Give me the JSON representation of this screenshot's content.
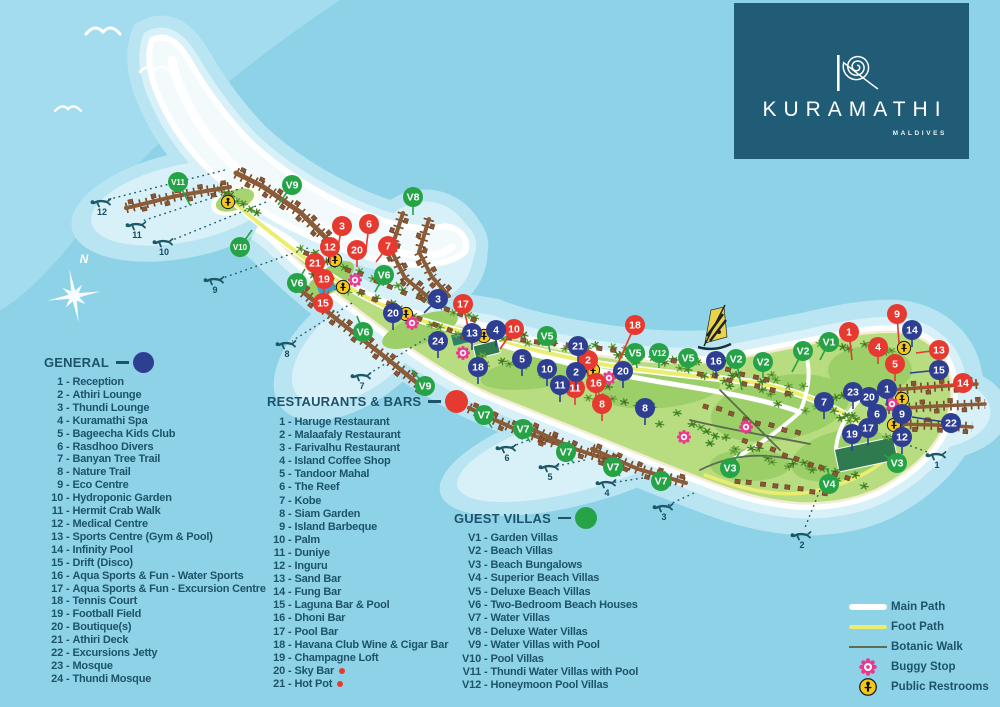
{
  "logo": {
    "brand": "KURAMATHI",
    "subtitle": "MALDIVES"
  },
  "compass_label": "N",
  "legend_separator": "-",
  "colors": {
    "marker_general": "#2e3f92",
    "marker_restaurant": "#e6392f",
    "marker_villa": "#27a347",
    "restroom": "#f3c71c",
    "buggy": "#e8398f",
    "main_path": "#ffffff",
    "foot_path": "#e9ee6e",
    "botanic_walk": "#5c6b52",
    "text": "#1d536a",
    "logo_bg": "#205c76",
    "sea": "#8ed2e8"
  },
  "legends": {
    "general": {
      "title": "GENERAL",
      "items": [
        {
          "n": "1",
          "label": "Reception"
        },
        {
          "n": "2",
          "label": "Athiri Lounge"
        },
        {
          "n": "3",
          "label": "Thundi Lounge"
        },
        {
          "n": "4",
          "label": "Kuramathi Spa"
        },
        {
          "n": "5",
          "label": "Bageecha Kids Club"
        },
        {
          "n": "6",
          "label": "Rasdhoo Divers"
        },
        {
          "n": "7",
          "label": "Banyan Tree Trail"
        },
        {
          "n": "8",
          "label": "Nature Trail"
        },
        {
          "n": "9",
          "label": "Eco Centre"
        },
        {
          "n": "10",
          "label": "Hydroponic Garden"
        },
        {
          "n": "11",
          "label": "Hermit Crab Walk"
        },
        {
          "n": "12",
          "label": "Medical Centre"
        },
        {
          "n": "13",
          "label": "Sports Centre (Gym & Pool)"
        },
        {
          "n": "14",
          "label": "Infinity Pool"
        },
        {
          "n": "15",
          "label": "Drift (Disco)"
        },
        {
          "n": "16",
          "label": "Aqua Sports & Fun - Water Sports"
        },
        {
          "n": "17",
          "label": "Aqua Sports & Fun - Excursion Centre"
        },
        {
          "n": "18",
          "label": "Tennis Court"
        },
        {
          "n": "19",
          "label": "Football Field"
        },
        {
          "n": "20",
          "label": "Boutique(s)"
        },
        {
          "n": "21",
          "label": "Athiri Deck"
        },
        {
          "n": "22",
          "label": "Excursions Jetty"
        },
        {
          "n": "23",
          "label": "Mosque"
        },
        {
          "n": "24",
          "label": "Thundi Mosque"
        }
      ]
    },
    "restaurants": {
      "title": "RESTAURANTS & BARS",
      "items": [
        {
          "n": "1",
          "label": "Haruge Restaurant"
        },
        {
          "n": "2",
          "label": "Malaafaly Restaurant"
        },
        {
          "n": "3",
          "label": "Farivalhu Restaurant"
        },
        {
          "n": "4",
          "label": "Island Coffee Shop"
        },
        {
          "n": "5",
          "label": "Tandoor Mahal"
        },
        {
          "n": "6",
          "label": "The Reef"
        },
        {
          "n": "7",
          "label": "Kobe"
        },
        {
          "n": "8",
          "label": "Siam Garden"
        },
        {
          "n": "9",
          "label": "Island Barbeque"
        },
        {
          "n": "10",
          "label": "Palm"
        },
        {
          "n": "11",
          "label": "Duniye"
        },
        {
          "n": "12",
          "label": "Inguru"
        },
        {
          "n": "13",
          "label": "Sand Bar"
        },
        {
          "n": "14",
          "label": "Fung Bar"
        },
        {
          "n": "15",
          "label": "Laguna Bar & Pool"
        },
        {
          "n": "16",
          "label": "Dhoni Bar"
        },
        {
          "n": "17",
          "label": "Pool Bar"
        },
        {
          "n": "18",
          "label": "Havana Club Wine & Cigar Bar"
        },
        {
          "n": "19",
          "label": "Champagne Loft"
        },
        {
          "n": "20",
          "label": "Sky Bar",
          "dot": true
        },
        {
          "n": "21",
          "label": "Hot Pot",
          "dot": true
        }
      ]
    },
    "villas": {
      "title": "GUEST VILLAS",
      "items": [
        {
          "n": "V1",
          "label": "Garden Villas"
        },
        {
          "n": "V2",
          "label": "Beach Villas"
        },
        {
          "n": "V3",
          "label": "Beach Bungalows"
        },
        {
          "n": "V4",
          "label": "Superior Beach Villas"
        },
        {
          "n": "V5",
          "label": "Deluxe Beach Villas"
        },
        {
          "n": "V6",
          "label": "Two-Bedroom Beach Houses"
        },
        {
          "n": "V7",
          "label": "Water Villas"
        },
        {
          "n": "V8",
          "label": "Deluxe Water Villas"
        },
        {
          "n": "V9",
          "label": "Water Villas with Pool"
        },
        {
          "n": "V10",
          "label": "Pool Villas"
        },
        {
          "n": "V11",
          "label": "Thundi Water Villas with Pool"
        },
        {
          "n": "V12",
          "label": "Honeymoon Pool Villas"
        }
      ]
    }
  },
  "path_legend": {
    "items": [
      {
        "key": "main",
        "label": "Main Path"
      },
      {
        "key": "foot",
        "label": "Foot Path"
      },
      {
        "key": "botanic",
        "label": "Botanic Walk"
      },
      {
        "key": "buggy",
        "label": "Buggy Stop"
      },
      {
        "key": "restroom",
        "label": "Public Restrooms"
      }
    ]
  },
  "map": {
    "markers_general": [
      {
        "n": "3",
        "x": 438,
        "y": 299,
        "lx": 424,
        "ly": 313
      },
      {
        "n": "13",
        "x": 472,
        "y": 333
      },
      {
        "n": "4",
        "x": 496,
        "y": 330
      },
      {
        "n": "24",
        "x": 438,
        "y": 341
      },
      {
        "n": "18",
        "x": 478,
        "y": 367
      },
      {
        "n": "5",
        "x": 522,
        "y": 359
      },
      {
        "n": "10",
        "x": 547,
        "y": 369
      },
      {
        "n": "21",
        "x": 578,
        "y": 346
      },
      {
        "n": "2",
        "x": 576,
        "y": 372
      },
      {
        "n": "11",
        "x": 560,
        "y": 385
      },
      {
        "n": "20",
        "x": 623,
        "y": 371
      },
      {
        "n": "8",
        "x": 645,
        "y": 408
      },
      {
        "n": "16",
        "x": 716,
        "y": 361
      },
      {
        "n": "20",
        "x": 393,
        "y": 313
      },
      {
        "n": "14",
        "x": 912,
        "y": 330
      },
      {
        "n": "15",
        "x": 939,
        "y": 370,
        "lx": 910,
        "ly": 373
      },
      {
        "n": "1",
        "x": 887,
        "y": 389
      },
      {
        "n": "23",
        "x": 853,
        "y": 392
      },
      {
        "n": "20",
        "x": 869,
        "y": 397
      },
      {
        "n": "7",
        "x": 824,
        "y": 402
      },
      {
        "n": "6",
        "x": 877,
        "y": 414
      },
      {
        "n": "9",
        "x": 902,
        "y": 414
      },
      {
        "n": "17",
        "x": 868,
        "y": 428
      },
      {
        "n": "19",
        "x": 852,
        "y": 434
      },
      {
        "n": "12",
        "x": 902,
        "y": 437
      },
      {
        "n": "22",
        "x": 951,
        "y": 423,
        "lx": 912,
        "ly": 417
      }
    ],
    "markers_restaurants": [
      {
        "n": "3",
        "x": 342,
        "y": 226,
        "lx": 337,
        "ly": 252
      },
      {
        "n": "6",
        "x": 369,
        "y": 224,
        "lx": 366,
        "ly": 250
      },
      {
        "n": "12",
        "x": 330,
        "y": 247
      },
      {
        "n": "20",
        "x": 357,
        "y": 250
      },
      {
        "n": "7",
        "x": 388,
        "y": 246,
        "lx": 376,
        "ly": 262
      },
      {
        "n": "21",
        "x": 315,
        "y": 263
      },
      {
        "n": "19",
        "x": 324,
        "y": 279
      },
      {
        "n": "15",
        "x": 323,
        "y": 303,
        "lx": 329,
        "ly": 291
      },
      {
        "n": "17",
        "x": 463,
        "y": 304,
        "lx": 468,
        "ly": 327
      },
      {
        "n": "10",
        "x": 514,
        "y": 329,
        "lx": 500,
        "ly": 349
      },
      {
        "n": "2",
        "x": 588,
        "y": 360
      },
      {
        "n": "11",
        "x": 575,
        "y": 388
      },
      {
        "n": "16",
        "x": 596,
        "y": 383
      },
      {
        "n": "8",
        "x": 602,
        "y": 404
      },
      {
        "n": "18",
        "x": 635,
        "y": 325,
        "lx": 612,
        "ly": 377
      },
      {
        "n": "9",
        "x": 897,
        "y": 314,
        "lx": 899,
        "ly": 343
      },
      {
        "n": "1",
        "x": 849,
        "y": 332,
        "lx": 852,
        "ly": 360
      },
      {
        "n": "4",
        "x": 878,
        "y": 347
      },
      {
        "n": "13",
        "x": 939,
        "y": 350,
        "lx": 916,
        "ly": 353
      },
      {
        "n": "5",
        "x": 895,
        "y": 364
      },
      {
        "n": "14",
        "x": 963,
        "y": 383,
        "lx": 916,
        "ly": 388
      }
    ],
    "markers_villas": [
      {
        "n": "V11",
        "x": 178,
        "y": 182,
        "lx": 190,
        "ly": 205
      },
      {
        "n": "V9",
        "x": 292,
        "y": 185,
        "lx": 278,
        "ly": 205
      },
      {
        "n": "V10",
        "x": 240,
        "y": 247,
        "lx": 252,
        "ly": 230
      },
      {
        "n": "V8",
        "x": 413,
        "y": 197,
        "lx": 413,
        "ly": 215
      },
      {
        "n": "V6",
        "x": 297,
        "y": 283,
        "lx": 305,
        "ly": 269
      },
      {
        "n": "V6",
        "x": 384,
        "y": 275,
        "lx": 375,
        "ly": 292
      },
      {
        "n": "V6",
        "x": 363,
        "y": 332,
        "lx": 357,
        "ly": 316
      },
      {
        "n": "V9",
        "x": 425,
        "y": 386,
        "lx": 412,
        "ly": 370
      },
      {
        "n": "V5",
        "x": 547,
        "y": 336,
        "lx": 550,
        "ly": 352
      },
      {
        "n": "V5",
        "x": 635,
        "y": 353,
        "lx": 637,
        "ly": 368
      },
      {
        "n": "V12",
        "x": 659,
        "y": 353,
        "lx": 659,
        "ly": 368
      },
      {
        "n": "V5",
        "x": 688,
        "y": 358,
        "lx": 688,
        "ly": 372
      },
      {
        "n": "V2",
        "x": 736,
        "y": 359,
        "lx": 742,
        "ly": 390
      },
      {
        "n": "V2",
        "x": 763,
        "y": 362,
        "lx": 763,
        "ly": 378
      },
      {
        "n": "V2",
        "x": 803,
        "y": 351,
        "lx": 792,
        "ly": 372
      },
      {
        "n": "V1",
        "x": 829,
        "y": 342,
        "lx": 820,
        "ly": 360
      },
      {
        "n": "V7",
        "x": 484,
        "y": 415,
        "lx": 492,
        "ly": 428
      },
      {
        "n": "V7",
        "x": 523,
        "y": 429,
        "lx": 530,
        "ly": 442
      },
      {
        "n": "V7",
        "x": 566,
        "y": 452,
        "lx": 573,
        "ly": 462
      },
      {
        "n": "V7",
        "x": 613,
        "y": 467,
        "lx": 620,
        "ly": 476
      },
      {
        "n": "V7",
        "x": 661,
        "y": 481,
        "lx": 667,
        "ly": 488
      },
      {
        "n": "V3",
        "x": 730,
        "y": 468,
        "lx": 740,
        "ly": 452
      },
      {
        "n": "V4",
        "x": 829,
        "y": 484,
        "lx": 828,
        "ly": 468
      },
      {
        "n": "V3",
        "x": 897,
        "y": 463,
        "lx": 884,
        "ly": 455
      }
    ],
    "restrooms": [
      [
        228,
        202
      ],
      [
        335,
        260
      ],
      [
        343,
        287
      ],
      [
        406,
        314
      ],
      [
        484,
        336
      ],
      [
        593,
        370
      ],
      [
        904,
        348
      ],
      [
        902,
        399
      ],
      [
        894,
        425
      ]
    ],
    "buggy_stops": [
      [
        355,
        280
      ],
      [
        412,
        323
      ],
      [
        463,
        353
      ],
      [
        609,
        378
      ],
      [
        684,
        437
      ],
      [
        746,
        427
      ],
      [
        892,
        404
      ]
    ],
    "dive_sites": [
      {
        "n": "12",
        "x": 100,
        "y": 203
      },
      {
        "n": "11",
        "x": 135,
        "y": 226
      },
      {
        "n": "10",
        "x": 162,
        "y": 243
      },
      {
        "n": "9",
        "x": 213,
        "y": 281
      },
      {
        "n": "8",
        "x": 285,
        "y": 345
      },
      {
        "n": "7",
        "x": 360,
        "y": 377
      },
      {
        "n": "6",
        "x": 505,
        "y": 449
      },
      {
        "n": "5",
        "x": 548,
        "y": 468
      },
      {
        "n": "4",
        "x": 605,
        "y": 484
      },
      {
        "n": "3",
        "x": 662,
        "y": 508
      },
      {
        "n": "2",
        "x": 800,
        "y": 536
      },
      {
        "n": "1",
        "x": 935,
        "y": 456
      }
    ]
  }
}
